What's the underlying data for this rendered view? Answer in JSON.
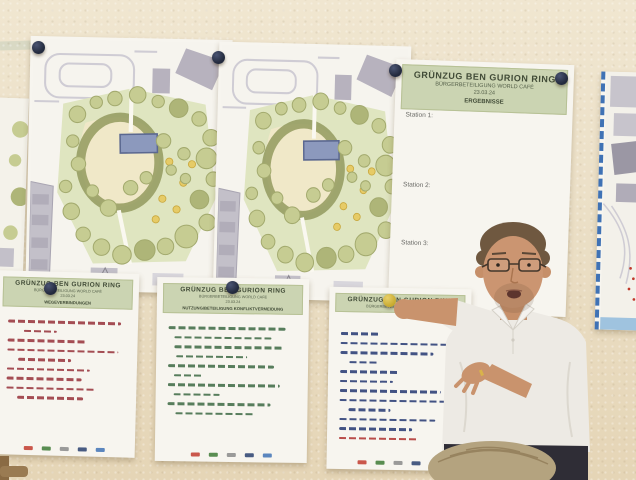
{
  "results_poster": {
    "title": "GRÜNZUG BEN GURION RING",
    "subtitle": "BÜRGERBETEILIGUNG WORLD CAFÉ",
    "date": "23.03.24",
    "section": "ERGEBNISSE",
    "stations": [
      "Station 1:",
      "Station 2:",
      "Station 3:"
    ]
  },
  "flipcharts": [
    {
      "title": "GRÜNZUG BEN GURION RING",
      "subtitle": "BÜRGERBETEILIGUNG WORLD CAFÉ",
      "date": "23.03.24",
      "topic": "WEGEVERBINDUNGEN",
      "ink": "#9b3a42",
      "note_lines": [
        {
          "i": 3,
          "w": 90
        },
        {
          "i": 16,
          "w": 26
        },
        {
          "i": 3,
          "w": 62
        },
        {
          "i": 3,
          "w": 88
        },
        {
          "i": 12,
          "w": 42
        },
        {
          "i": 3,
          "w": 66
        },
        {
          "i": 3,
          "w": 60
        },
        {
          "i": 3,
          "w": 70
        },
        {
          "i": 12,
          "w": 52
        }
      ]
    },
    {
      "title": "GRÜNZUG BEN GURION RING",
      "subtitle": "BÜRGERBETEILIGUNG WORLD CAFÉ",
      "date": "23.03.24",
      "topic": "NUTZUNG/BETEILIGUNG KONFLIKTVERMEIDUNG",
      "ink": "#45704c",
      "note_lines": [
        {
          "i": 3,
          "w": 86
        },
        {
          "i": 7,
          "w": 72
        },
        {
          "i": 7,
          "w": 80
        },
        {
          "i": 9,
          "w": 52
        },
        {
          "i": 3,
          "w": 78
        },
        {
          "i": 7,
          "w": 22
        },
        {
          "i": 3,
          "w": 82
        },
        {
          "i": 7,
          "w": 34
        },
        {
          "i": 3,
          "w": 76
        },
        {
          "i": 9,
          "w": 58
        }
      ]
    },
    {
      "title": "GRÜNZUG BEN GURION RING",
      "subtitle": "BÜRGERBETEILIGUNG WORLD CAFÉ",
      "date": "23.03.24",
      "topic": "",
      "ink": "#2f4178",
      "note_lines": [
        {
          "i": 3,
          "w": 30
        },
        {
          "i": 3,
          "w": 88
        },
        {
          "i": 3,
          "w": 74
        },
        {
          "i": 10,
          "w": 24
        },
        {
          "i": 3,
          "w": 46
        },
        {
          "i": 3,
          "w": 42
        },
        {
          "i": 3,
          "w": 80
        },
        {
          "i": 3,
          "w": 84
        },
        {
          "i": 10,
          "w": 34
        },
        {
          "i": 3,
          "w": 76
        },
        {
          "i": 3,
          "w": 58
        },
        {
          "i": 3,
          "w": 64,
          "c": "#b23a38"
        }
      ]
    }
  ],
  "flipchart_footer_logo_colors": [
    "#c23b2e",
    "#3d7a35",
    "#8a8a8a",
    "#29406e",
    "#3f72b5"
  ],
  "colors": {
    "wall": "#ebdfc6",
    "header_band_green": "#cbd4b2",
    "pin_navy": "#232a3d",
    "pin_yellow": "#c7a92e",
    "map_border_blue": "#3f72b5",
    "park_lawn_green": "#dfe5c0",
    "plan_building_gray": "#b7b2be",
    "plan_feature_blue": "#8c99bd",
    "ink_red": "#9b3a42",
    "ink_green": "#45704c",
    "ink_blue": "#2f4178",
    "shirt_white": "#edeae4"
  }
}
